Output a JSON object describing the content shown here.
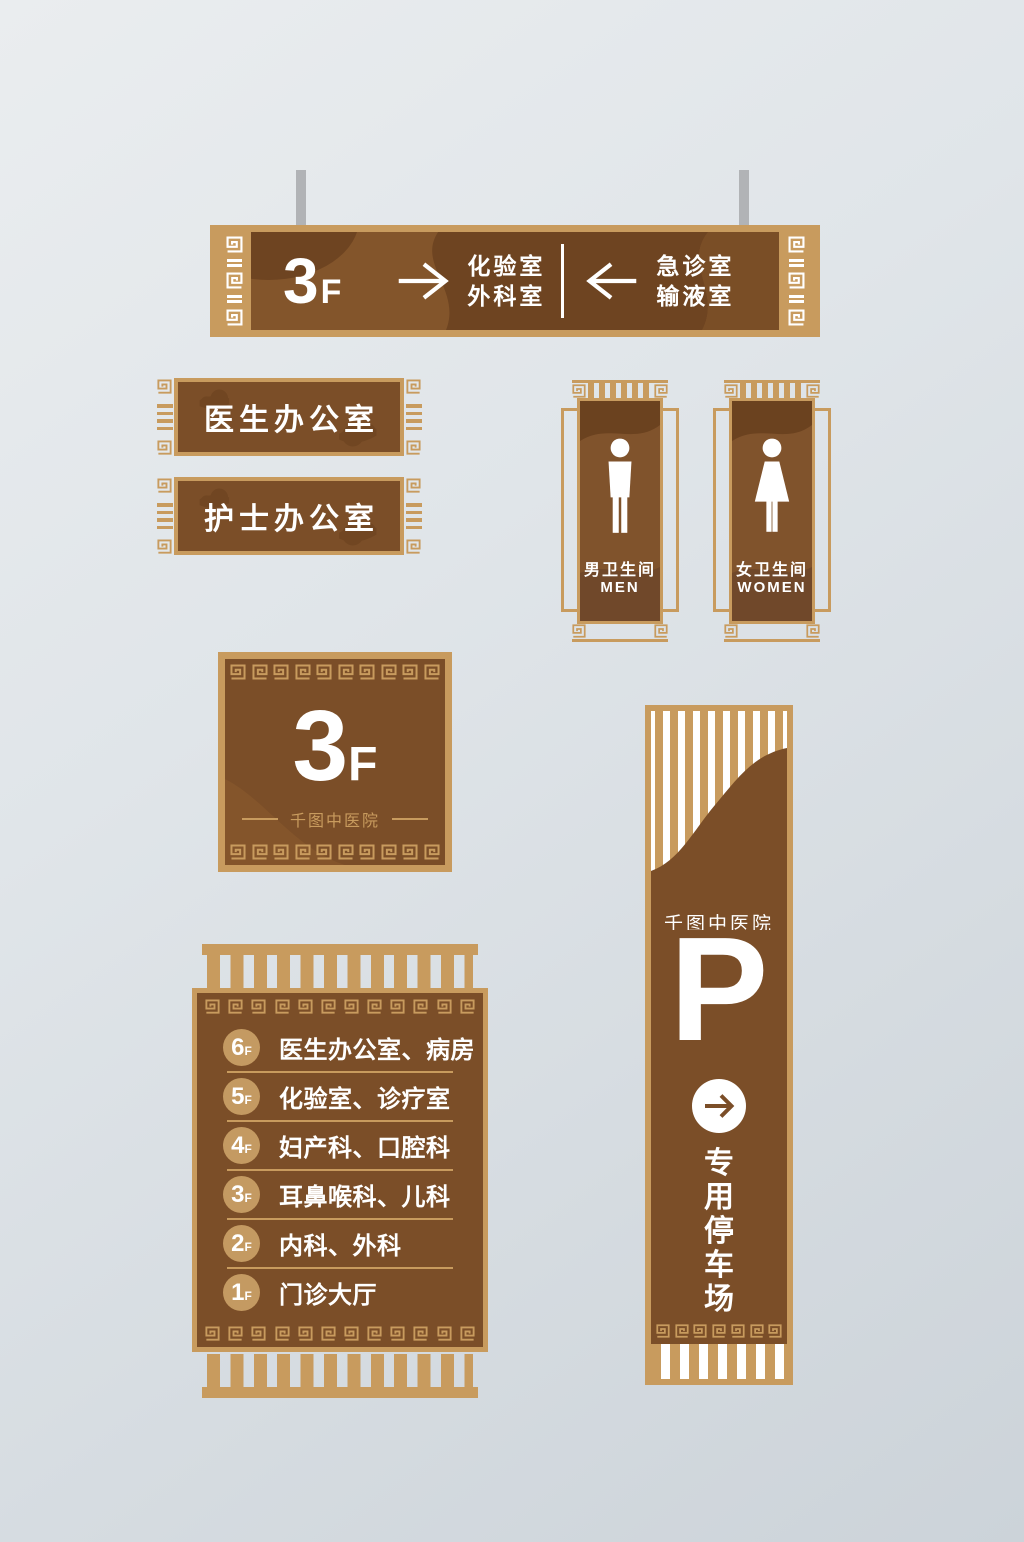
{
  "palette": {
    "tan": "#c89b5e",
    "brown": "#7b4e28",
    "brown_dark": "#6b421f",
    "brown_light": "#84552b",
    "text_white": "#ffffff",
    "rod_gray": "#b1b3b6",
    "background": "#dde2e6"
  },
  "icons": {
    "meander_spiral": "greek-key-spiral",
    "male_figure": "male-restroom-icon",
    "female_figure": "female-restroom-icon",
    "arrow_right": "arrow-right-icon",
    "arrow_left": "arrow-left-icon",
    "circle_arrow": "circle-arrow-right-icon"
  },
  "directional_sign": {
    "floor": "3",
    "suffix": "F",
    "right_line1": "化验室",
    "right_line2": "外科室",
    "left_line1": "急诊室",
    "left_line2": "输液室"
  },
  "door_plates": {
    "doctor": "医生办公室",
    "nurse": "护士办公室"
  },
  "restrooms": {
    "men_zh": "男卫生间",
    "men_en": "MEN",
    "women_zh": "女卫生间",
    "women_en": "WOMEN"
  },
  "floor_sign": {
    "floor": "3",
    "suffix": "F",
    "hospital": "千图中医院"
  },
  "directory_sign": {
    "rows": [
      {
        "floor": "6",
        "suffix": "F",
        "label": "医生办公室、病房"
      },
      {
        "floor": "5",
        "suffix": "F",
        "label": "化验室、诊疗室"
      },
      {
        "floor": "4",
        "suffix": "F",
        "label": "妇产科、口腔科"
      },
      {
        "floor": "3",
        "suffix": "F",
        "label": "耳鼻喉科、儿科"
      },
      {
        "floor": "2",
        "suffix": "F",
        "label": "内科、外科"
      },
      {
        "floor": "1",
        "suffix": "F",
        "label": "门诊大厅"
      }
    ]
  },
  "parking_sign": {
    "hospital": "千图中医院",
    "symbol": "P",
    "label": "专用停车场"
  }
}
